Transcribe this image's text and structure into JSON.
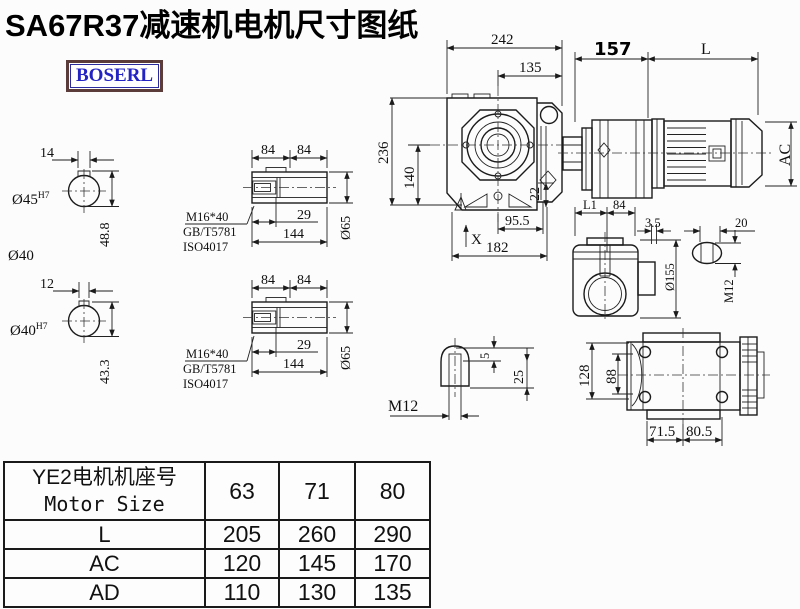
{
  "title": "SA67R37减速机电机尺寸图纸",
  "logo": {
    "text": "BOSERL"
  },
  "colors": {
    "line": "#1b1b1b",
    "logo_text": "#2424c4",
    "logo_border": "#5c3b3b",
    "background": "#fcfcfc"
  },
  "dims": {
    "shaft_a": {
      "keyway_w": "14",
      "bore": "Ø45",
      "bore_tol": "H7",
      "height": "48.8",
      "outer": "Ø40"
    },
    "shaft_b": {
      "keyway_w": "12",
      "bore": "Ø40",
      "bore_tol": "H7",
      "height": "43.3"
    },
    "hollow_a": {
      "d84l": "84",
      "d84r": "84",
      "bolt": "M16*40",
      "std1": "GB/T5781",
      "std2": "ISO4017",
      "d29": "29",
      "d144": "144",
      "dia": "Ø65"
    },
    "hollow_b": {
      "d84l": "84",
      "d84r": "84",
      "bolt": "M16*40",
      "std1": "GB/T5781",
      "std2": "ISO4017",
      "d29": "29",
      "d144": "144",
      "dia": "Ø65"
    },
    "front": {
      "d242": "242",
      "d135": "135",
      "d157": "157",
      "dL": "L",
      "d236": "236",
      "d140": "140",
      "d22": "22",
      "d955": "95.5",
      "d182": "182",
      "dX": "X",
      "dAC": "AC"
    },
    "side": {
      "dL1": "L1",
      "d84": "84",
      "d35": "3.5",
      "dia155": "Ø155",
      "d20": "20",
      "m12": "M12"
    },
    "keyseat": {
      "m12": "M12",
      "d5": "5",
      "d25": "25"
    },
    "bottom": {
      "d128": "128",
      "d88": "88",
      "d715": "71.5",
      "d805": "80.5"
    }
  },
  "table": {
    "header_cn": "YE2电机机座号",
    "header_en": "Motor Size",
    "sizes": [
      "63",
      "71",
      "80"
    ],
    "rows": [
      {
        "label": "L",
        "values": [
          "205",
          "260",
          "290"
        ]
      },
      {
        "label": "AC",
        "values": [
          "120",
          "145",
          "170"
        ]
      },
      {
        "label": "AD",
        "values": [
          "110",
          "130",
          "135"
        ]
      }
    ]
  }
}
